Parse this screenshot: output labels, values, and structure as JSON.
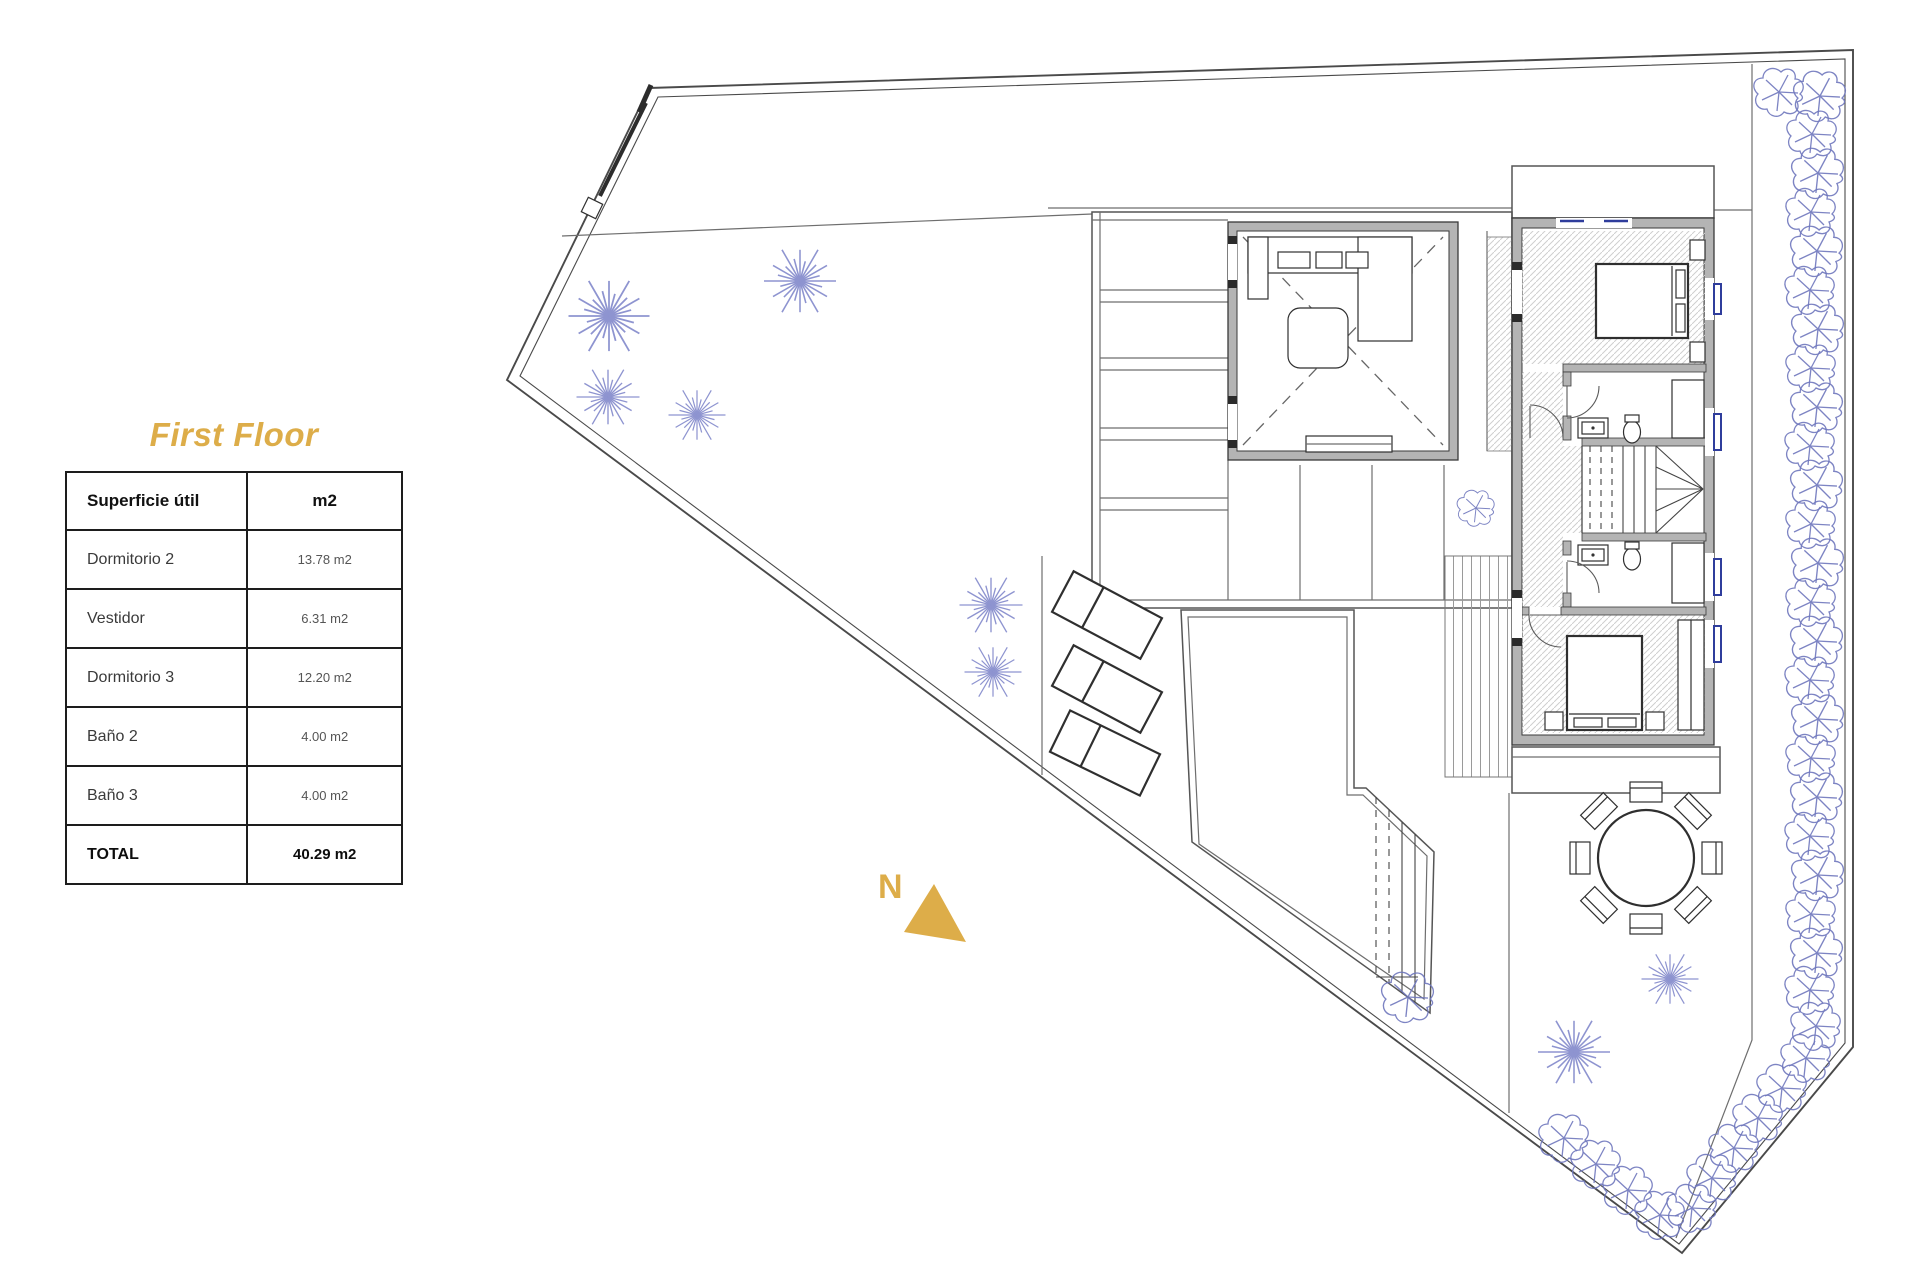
{
  "title": {
    "text": "First Floor"
  },
  "area_table": {
    "header": {
      "col1": "Superficie útil",
      "col2": "m2"
    },
    "rows": [
      {
        "name": "Dormitorio 2",
        "value": "13.78 m2"
      },
      {
        "name": "Vestidor",
        "value": "6.31 m2"
      },
      {
        "name": "Dormitorio 3",
        "value": "12.20 m2"
      },
      {
        "name": "Baño 2",
        "value": "4.00 m2"
      },
      {
        "name": "Baño 3",
        "value": "4.00 m2"
      }
    ],
    "total": {
      "name": "TOTAL",
      "value": "40.29 m2"
    }
  },
  "compass": {
    "label": "N"
  },
  "colors": {
    "gold": "#DDAD49",
    "planline": "#4a4a4a",
    "wallfill": "#b4b4b4",
    "veg": "#7b82c8",
    "veg2": "#6f77bd",
    "winblue": "#2f3d9c",
    "hatch": "#cfcfcf"
  }
}
